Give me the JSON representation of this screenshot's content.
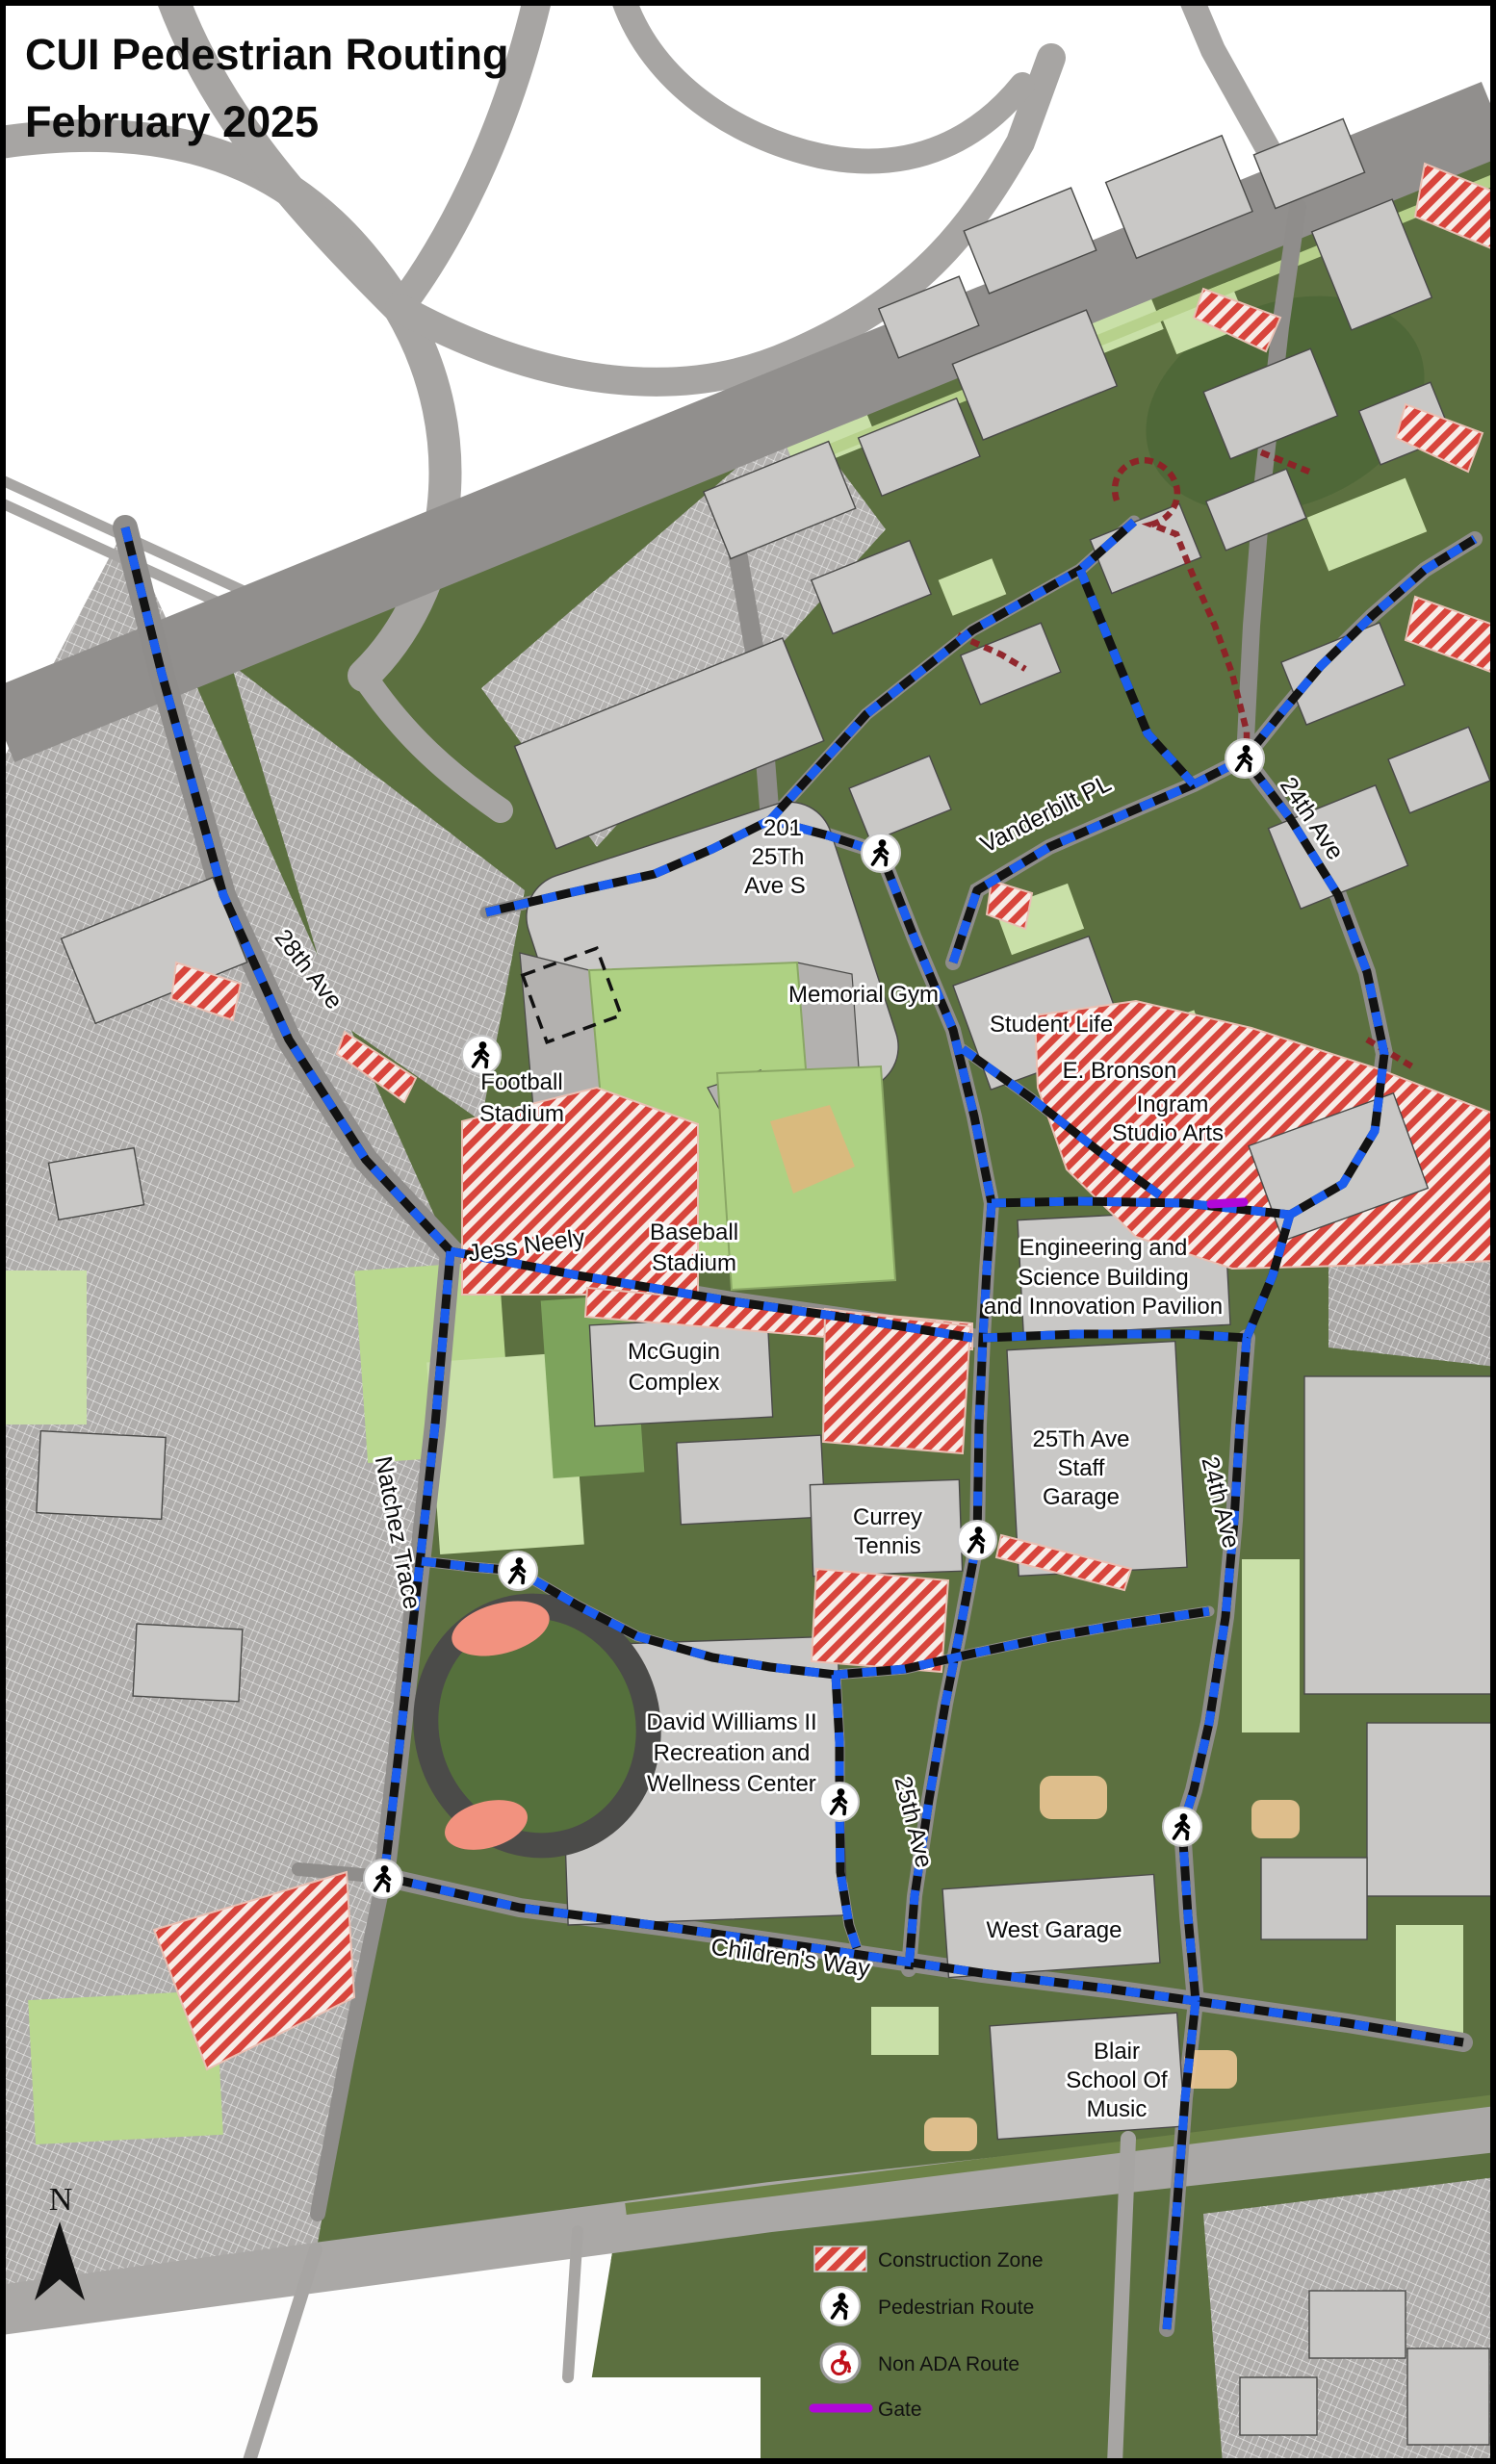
{
  "title": {
    "line1": "CUI Pedestrian Routing",
    "line2": "February 2025"
  },
  "north": {
    "label": "N"
  },
  "legend": {
    "construction": "Construction Zone",
    "pedestrian": "Pedestrian Route",
    "non_ada": "Non ADA Route",
    "gate": "Gate"
  },
  "streets": {
    "ave28": "28th Ave",
    "natchez": "Natchez Trace",
    "jess_neely": "Jess Neely",
    "childrens_way": "Children's Way",
    "ave25": "25th Ave",
    "ave24_upper": "24th Ave",
    "ave24_lower": "24th Ave",
    "vanderbilt": "Vanderbilt PL"
  },
  "labels": {
    "b201": [
      "201",
      "25Th",
      "Ave S"
    ],
    "memorial": [
      "Memorial Gym"
    ],
    "student_life": [
      "Student Life"
    ],
    "ebronson": [
      "E. Bronson",
      "Ingram",
      "Studio Arts"
    ],
    "engineering": [
      "Engineering and",
      "Science Building",
      "and Innovation Pavilion"
    ],
    "staff_garage": [
      "25Th Ave",
      "Staff",
      "Garage"
    ],
    "currey": [
      "Currey",
      "Tennis"
    ],
    "mcgugin": [
      "McGugin",
      "Complex"
    ],
    "football": [
      "Football",
      "Stadium"
    ],
    "baseball": [
      "Baseball",
      "Stadium"
    ],
    "david_williams": [
      "David Williams II",
      "Recreation and",
      "Wellness Center"
    ],
    "west_garage": [
      "West Garage"
    ],
    "blair": [
      "Blair",
      "School Of",
      "Music"
    ]
  },
  "colors": {
    "pedestrian_route_blue": "#1a5df0",
    "route_black": "#121212",
    "construction_red": "#d8453c",
    "non_ada_red": "#8e2026",
    "gate_purple": "#b007d8",
    "campus_green": "#5c7040",
    "lawn_green": "#c9e0a8",
    "road_gray": "#8f8d8b",
    "building_gray": "#c9c8c6"
  }
}
